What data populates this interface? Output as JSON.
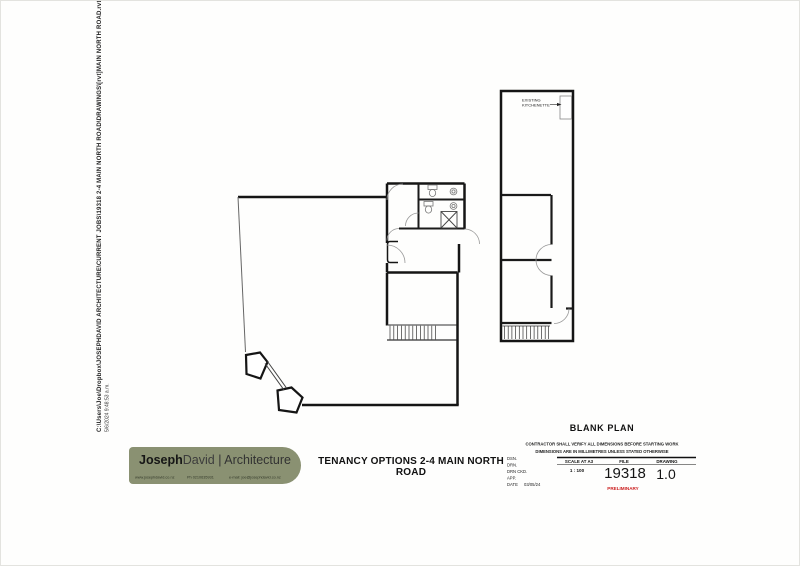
{
  "meta_text": {
    "file_path": "C:\\Users\\Joe\\Dropbox\\JOSEPHDAVID ARCHITECTURE\\CURRENT JOBS\\19318 2-4 MAIN NORTH ROAD\\DRAWINGS\\[rvt]MAIN NORTH ROAD.rvt",
    "timestamp": "5/6/2024 9:48:53 a.m."
  },
  "plan_labels": {
    "kitchenette_line1": "EXISTING",
    "kitchenette_line2": "KITCHENETTE"
  },
  "logo": {
    "name_primary": "Joseph",
    "name_secondary": "David",
    "separator": " | ",
    "discipline": "Architecture",
    "website": "www.josephdavid.co.nz",
    "phone": "Ph 0210635931",
    "email": "e-mail: joe@josephdavid.co.nz",
    "brand_color": "#8a9172"
  },
  "sheet": {
    "title": "TENANCY OPTIONS 2-4 MAIN NORTH ROAD"
  },
  "title_block": {
    "drawing_name": "BLANK PLAN",
    "note_line1": "CONTRACTOR SHALL VERIFY ALL DIMENSIONS BEFORE STARTING WORK",
    "note_line2": "DIMENSIONS ARE IN MILLIMETRES UNLESS STATED OTHERWISE",
    "labels": {
      "dsn": "DSN.",
      "drn": "DRN.",
      "drn_ckd": "DRN CKD.",
      "app": "APP.",
      "date": "DATE"
    },
    "date_value": "03/05/24",
    "scale_label": "SCALE AT A3",
    "scale_value": "1 : 100",
    "file_label": "FILE",
    "file_value": "19318",
    "drawing_label": "DRAWING",
    "drawing_value": "1.0",
    "status": "PRELIMINARY",
    "status_color": "#cc2222"
  }
}
